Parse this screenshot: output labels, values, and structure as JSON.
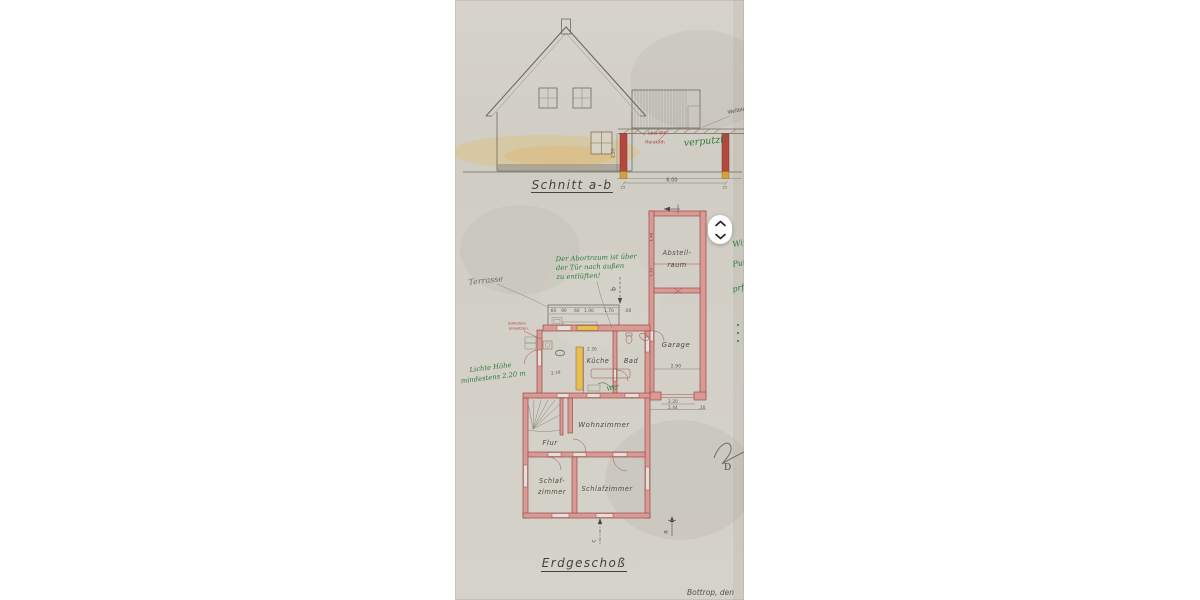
{
  "viewer": {
    "nav": {
      "up_icon": "chevron-up",
      "down_icon": "chevron-down"
    }
  },
  "document": {
    "section": {
      "title": "Schnitt a-b",
      "notes": {
        "red_line1": "über 8½",
        "red_line2": "Heraklith",
        "green": "verputzt!",
        "pencil_roof": "Wellblech"
      },
      "dims": {
        "span": "6.00",
        "height": "2.20",
        "post_left": "25",
        "post_right": "25"
      }
    },
    "plan": {
      "title": "Erdgeschoß",
      "rooms": {
        "abstellraum_line1": "Abstell-",
        "abstellraum_line2": "raum",
        "garage": "Garage",
        "kueche": "Küche",
        "bad": "Bad",
        "wohnzimmer": "Wohnzimmer",
        "flur": "Flur",
        "schlafzimmer_links_line1": "Schlaf-",
        "schlafzimmer_links_line2": "zimmer",
        "schlafzimmer_rechts": "Schlafzimmer"
      },
      "labels": {
        "terrasse": "Terrasse",
        "sohlstein_line1": "Sohlstein",
        "sohlstein_line2": "einsetzen.",
        "wc": "WC"
      },
      "dims": {
        "terrace": [
          "60",
          "90",
          "60",
          "1.00",
          "1.70",
          ".60"
        ],
        "kueche_width": "2.30",
        "wasch_width": "2.18",
        "abstell_a": "1.48",
        "abstell_b": "1.50",
        "garage_width": "2.90",
        "garage_door": "2.20",
        "garage_door_outer": "2.44",
        "wall": ".30"
      },
      "notes": {
        "vent": [
          "Der Abortraum ist über",
          "der Tür nach außen",
          "zu entlüften!"
        ],
        "height": [
          "Lichte Höhe",
          "mindestens 2.20 m"
        ]
      },
      "markers": {
        "a": "a",
        "b": "b",
        "c": "c"
      },
      "stamp_letter": "D"
    },
    "footer": {
      "place_date": "Bottrop, den"
    },
    "marginalia": [
      "Wird",
      "Putz",
      "prf."
    ],
    "colors": {
      "paper": "#d3d0c7",
      "wall_red": "#a05054",
      "ink_green": "#2f7b3c",
      "ink_red": "#a8403a",
      "highlight_yellow": "#e2c14e"
    }
  }
}
